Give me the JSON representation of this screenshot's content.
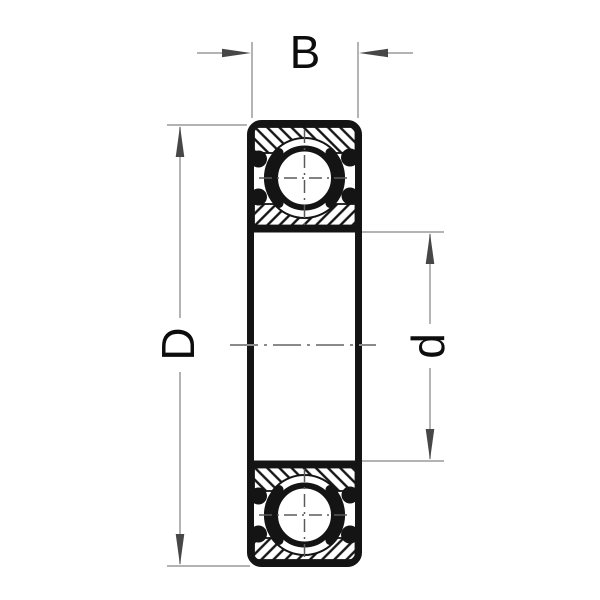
{
  "diagram": {
    "kind": "deep-groove-ball-bearing-cross-section",
    "labels": {
      "width": "B",
      "outer_diameter": "D",
      "bore_diameter": "d"
    },
    "colors": {
      "background": "#ffffff",
      "part_line": "#141414",
      "hatch_line": "#141414",
      "dim_line": "#9a9a9a",
      "arrow": "#474747",
      "centerline": "#8a8a8a",
      "label_text": "#0d0d0d"
    }
  }
}
